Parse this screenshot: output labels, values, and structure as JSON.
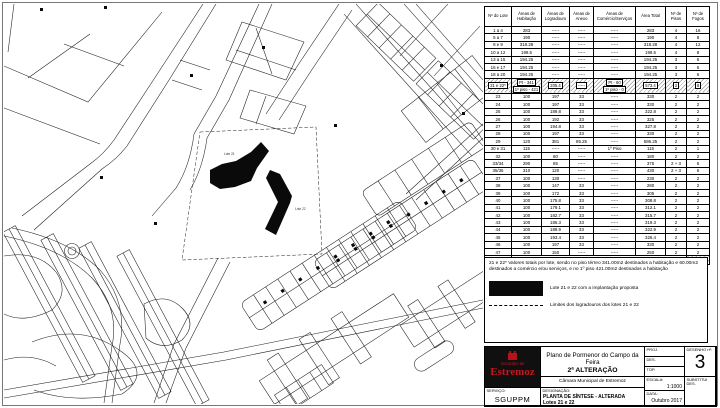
{
  "colors": {
    "accent_red": "#b5121b",
    "line_black": "#1c1c1c",
    "hatch_gray": "#9a9a9a"
  },
  "map": {
    "labels": {
      "lote21": "Lote 21",
      "lote22": "Lote 22"
    }
  },
  "table": {
    "headers": [
      "Nº do Lote",
      "Áreas de Habitação",
      "Áreas de Logradouro",
      "Áreas de Anexo",
      "Áreas de Comércio/Serviços",
      "Área Total",
      "Nº de Pisos",
      "Nº de Fogos"
    ],
    "rows": [
      {
        "cells": [
          "1 a 4",
          "283",
          "-----",
          "-----",
          "-----",
          "283",
          "4",
          "16"
        ]
      },
      {
        "cells": [
          "5 a 7",
          "190",
          "-----",
          "-----",
          "-----",
          "190",
          "4",
          "8"
        ]
      },
      {
        "cells": [
          "8 e 9",
          "318.28",
          "-----",
          "-----",
          "-----",
          "318.28",
          "4",
          "12"
        ]
      },
      {
        "cells": [
          "10 a 12",
          "199.5",
          "-----",
          "-----",
          "-----",
          "199.5",
          "4",
          "8"
        ]
      },
      {
        "cells": [
          "13 a 15",
          "194.25",
          "-----",
          "-----",
          "-----",
          "194.25",
          "3",
          "6"
        ]
      },
      {
        "cells": [
          "16 e 17",
          "194.25",
          "-----",
          "-----",
          "-----",
          "194.25",
          "3",
          "6"
        ]
      },
      {
        "cells": [
          "18 a 20",
          "194.25",
          "-----",
          "-----",
          "-----",
          "194.25",
          "3",
          "6"
        ]
      },
      {
        "hatched": true,
        "cells": [
          "21 e 22*",
          [
            "Pt - 341",
            "1º piso - 421"
          ],
          "205.4",
          "-----",
          [
            "Pt - 60",
            "1º piso - 0"
          ],
          "573.4",
          "2",
          "8"
        ]
      },
      {
        "cells": [
          "23",
          "100",
          "197",
          "33",
          "-----",
          "330",
          "2",
          "2"
        ]
      },
      {
        "cells": [
          "24",
          "100",
          "197",
          "33",
          "-----",
          "330",
          "2",
          "2"
        ]
      },
      {
        "cells": [
          "25",
          "100",
          "189.8",
          "33",
          "-----",
          "322.8",
          "2",
          "2"
        ]
      },
      {
        "cells": [
          "26",
          "100",
          "192",
          "33",
          "-----",
          "325",
          "2",
          "2"
        ]
      },
      {
        "cells": [
          "27",
          "100",
          "194.8",
          "33",
          "-----",
          "327.8",
          "2",
          "2"
        ]
      },
      {
        "cells": [
          "28",
          "100",
          "197",
          "33",
          "-----",
          "330",
          "2",
          "2"
        ]
      },
      {
        "cells": [
          "29",
          "120",
          "381",
          "85.25",
          "-----",
          "586.25",
          "2",
          "2"
        ]
      },
      {
        "cells": [
          "30 e 31",
          "115",
          "-----",
          "-----",
          "1º Piso",
          "115",
          "2",
          "1"
        ]
      },
      {
        "cells": [
          "32",
          "100",
          "80",
          "-----",
          "-----",
          "180",
          "2",
          "2"
        ]
      },
      {
        "cells": [
          "33/34",
          "290",
          "85",
          "-----",
          "-----",
          "375",
          "2 + 3",
          "6"
        ]
      },
      {
        "cells": [
          "35/36",
          "310",
          "120",
          "-----",
          "-----",
          "430",
          "2 + 3",
          "6"
        ]
      },
      {
        "cells": [
          "37",
          "100",
          "130",
          "-----",
          "-----",
          "230",
          "2",
          "2"
        ]
      },
      {
        "cells": [
          "38",
          "100",
          "147",
          "33",
          "-----",
          "280",
          "2",
          "2"
        ]
      },
      {
        "cells": [
          "39",
          "100",
          "172",
          "33",
          "-----",
          "305",
          "2",
          "2"
        ]
      },
      {
        "cells": [
          "40",
          "100",
          "175.8",
          "33",
          "-----",
          "308.8",
          "2",
          "2"
        ]
      },
      {
        "cells": [
          "41",
          "100",
          "179.1",
          "33",
          "-----",
          "312.1",
          "2",
          "2"
        ]
      },
      {
        "cells": [
          "42",
          "100",
          "182.7",
          "33",
          "-----",
          "315.7",
          "2",
          "2"
        ]
      },
      {
        "cells": [
          "43",
          "100",
          "186.3",
          "33",
          "-----",
          "319.3",
          "2",
          "2"
        ]
      },
      {
        "cells": [
          "44",
          "100",
          "189.9",
          "33",
          "-----",
          "322.9",
          "2",
          "2"
        ]
      },
      {
        "cells": [
          "45",
          "100",
          "193.4",
          "33",
          "-----",
          "326.4",
          "2",
          "2"
        ]
      },
      {
        "cells": [
          "46",
          "100",
          "197",
          "33",
          "-----",
          "330",
          "2",
          "2"
        ]
      },
      {
        "cells": [
          "47",
          "100",
          "150",
          "-----",
          "-----",
          "250",
          "2",
          "2"
        ]
      }
    ],
    "totals": {
      "label": "TOTAIS",
      "fogos": "141"
    }
  },
  "notes": {
    "text": "21 e 22* Valores totais por lote, sendo no piso térreo 341.00m2 destinados a habitação e 60.00m2 destinados a comércio e/ou serviços, e no 1º piso 421.00m2 destinados a habitação"
  },
  "legend": {
    "items": [
      {
        "symbol": "black-rect",
        "label": "Lote 21 e 22 com a implantação proposta"
      },
      {
        "symbol": "dashed-line",
        "label": "Limites dos logradouros dos lotes 21 e 22"
      }
    ]
  },
  "title_block": {
    "municipality_line1": "município de",
    "municipality_line2": "Estremoz",
    "title_line1": "Plano de Pormenor do Campo da Feira",
    "title_line2": "2ª ALTERAÇÃO",
    "subtitle": "Câmara Municipal de Estremoz",
    "servico_label": "SERVIÇO:",
    "servico_value": "SGUPPM",
    "designacao_label": "DESIGNAÇÃO:",
    "designacao_value1": "PLANTA DE SÍNTESE - ALTERADA",
    "designacao_value2": "Lotes 21 e 22",
    "proj_label": "PROJ.",
    "des_label": "DES.",
    "top_label": "TOP.",
    "escala_label": "ESCALA:",
    "escala_value": "1:1000",
    "data_label": "DATA:",
    "data_value": "Outubro 2017",
    "desenho_label": "DESENHO nº:",
    "desenho_value": "3",
    "substitui_label": "SUBSTITUI DES."
  }
}
